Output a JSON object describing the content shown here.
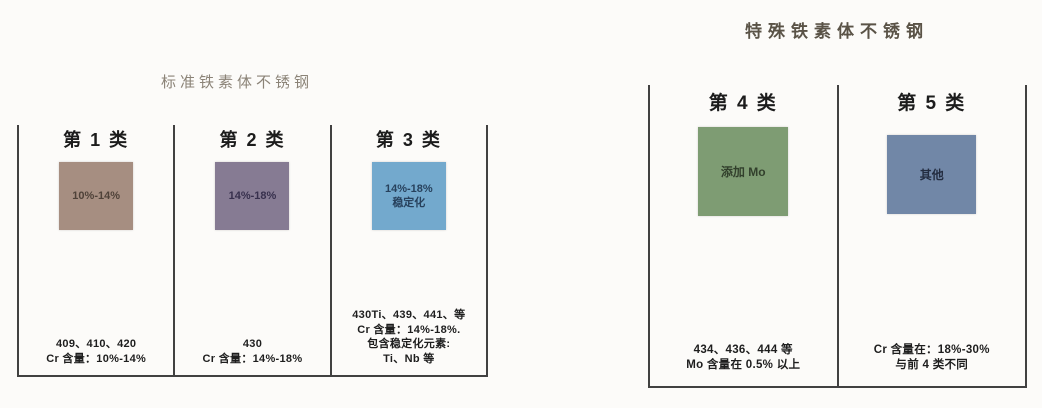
{
  "groups": [
    {
      "title": "标准铁素体不锈钢",
      "categories": [
        {
          "header": "第 1 类",
          "box_lines": [
            "10%-14%"
          ],
          "box_color": "#a68e81",
          "box_text_color": "#4f4239",
          "notes": [
            "409、410、420",
            "Cr 含量：10%-14%"
          ]
        },
        {
          "header": "第 2 类",
          "box_lines": [
            "14%-18%"
          ],
          "box_color": "#867b93",
          "box_text_color": "#37304d",
          "notes": [
            "430",
            "Cr 含量：14%-18%"
          ]
        },
        {
          "header": "第 3 类",
          "box_lines": [
            "14%-18%",
            "稳定化"
          ],
          "box_color": "#73a9cd",
          "box_text_color": "#27415c",
          "notes": [
            "430Ti、439、441、等",
            "Cr 含量：14%-18%.",
            "包含稳定化元素:",
            "Ti、Nb 等"
          ]
        }
      ]
    },
    {
      "title": "特殊铁素体不锈钢",
      "categories": [
        {
          "header": "第 4 类",
          "box_lines": [
            "添加 Mo"
          ],
          "box_color": "#7e9c73",
          "box_text_color": "#32402c",
          "notes": [
            "434、436、444 等",
            "Mo 含量在 0.5% 以上"
          ]
        },
        {
          "header": "第 5 类",
          "box_lines": [
            "其他"
          ],
          "box_color": "#7187a7",
          "box_text_color": "#232c40",
          "notes": [
            "Cr 含量在：18%-30%",
            "与前 4 类不同"
          ]
        }
      ]
    }
  ],
  "line_color": "#414141"
}
